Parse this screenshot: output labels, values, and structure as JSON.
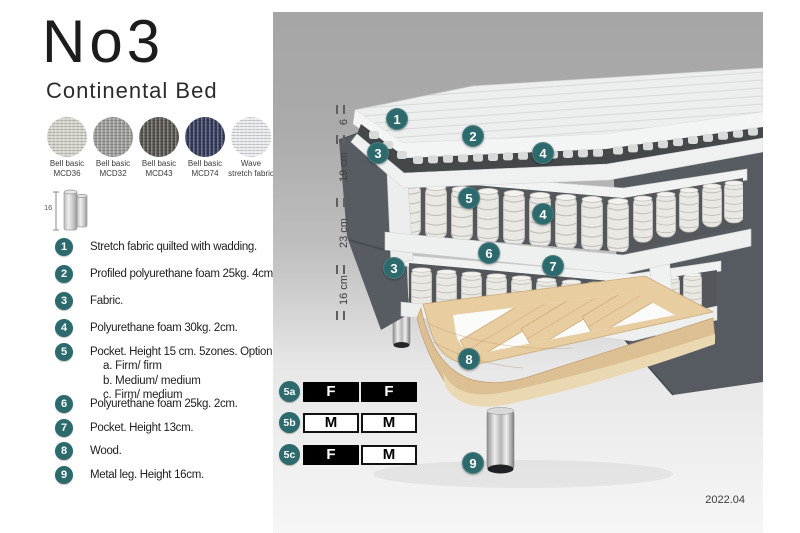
{
  "header": {
    "title": "No3",
    "subtitle": "Continental Bed"
  },
  "swatches": {
    "items": [
      {
        "line1": "Bell basic",
        "line2": "MCD36",
        "color": "#d5d2ca"
      },
      {
        "line1": "Bell basic",
        "line2": "MCD32",
        "color": "#9c9c9a"
      },
      {
        "line1": "Bell basic",
        "line2": "MCD43",
        "color": "#57544f"
      },
      {
        "line1": "Bell basic",
        "line2": "MCD74",
        "color": "#333a5c"
      },
      {
        "line1": "Wave",
        "line2": "stretch fabric",
        "color": "#e8eaed"
      }
    ]
  },
  "leg_icon": {
    "height_label": "16"
  },
  "legend": {
    "items": [
      {
        "num": "1",
        "text": "Stretch fabric quilted with wadding."
      },
      {
        "num": "2",
        "text": "Profiled polyurethane foam 25kg. 4cm."
      },
      {
        "num": "3",
        "text": "Fabric."
      },
      {
        "num": "4",
        "text": "Polyurethane foam 30kg. 2cm."
      },
      {
        "num": "5",
        "text": "Pocket. Height 15 cm. 5zones. Option:",
        "options": [
          "a. Firm/ firm",
          "b. Medium/ medium",
          "c. Firm/ medium"
        ]
      },
      {
        "num": "6",
        "text": "Polyurethane foam 25kg. 2cm."
      },
      {
        "num": "7",
        "text": "Pocket. Height 13cm."
      },
      {
        "num": "8",
        "text": "Wood."
      },
      {
        "num": "9",
        "text": "Metal leg. Height 16cm."
      }
    ]
  },
  "diagram": {
    "measurements": [
      {
        "label": "6"
      },
      {
        "label": "19 cm"
      },
      {
        "label": "23 cm"
      },
      {
        "label": "16 cm"
      }
    ],
    "callouts": [
      {
        "label": "1"
      },
      {
        "label": "2"
      },
      {
        "label": "4"
      },
      {
        "label": "3"
      },
      {
        "label": "5"
      },
      {
        "label": "4"
      },
      {
        "label": "6"
      },
      {
        "label": "3"
      },
      {
        "label": "7"
      },
      {
        "label": "8"
      },
      {
        "label": "9"
      }
    ],
    "firmness": [
      {
        "label": "5a",
        "cells": [
          {
            "letter": "F",
            "filled": true
          },
          {
            "letter": "F",
            "filled": true
          }
        ]
      },
      {
        "label": "5b",
        "cells": [
          {
            "letter": "M",
            "filled": false
          },
          {
            "letter": "M",
            "filled": false
          }
        ]
      },
      {
        "label": "5c",
        "cells": [
          {
            "letter": "F",
            "filled": true
          },
          {
            "letter": "M",
            "filled": false
          }
        ]
      }
    ],
    "version": "2022.04"
  },
  "colors": {
    "accent": "#2d6a6d",
    "fabric_dark": "#575c63",
    "mattress_white": "#eef0ef",
    "wood": "#e8cda0",
    "panel_gray": "#a7a7a7"
  }
}
